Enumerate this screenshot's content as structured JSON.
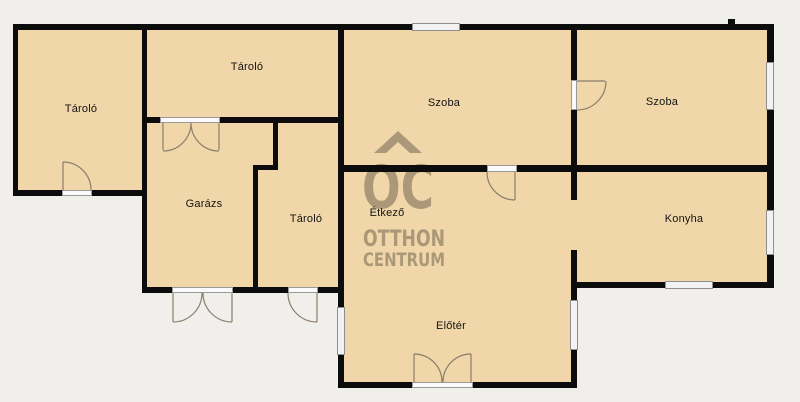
{
  "plan": {
    "type": "floorplan",
    "language": "hu"
  },
  "brand": {
    "logo_acronym": "OC",
    "name_line1": "OTTHON",
    "name_line2": "CENTRUM"
  },
  "rooms": [
    {
      "id": "storage-left",
      "label": "Tároló"
    },
    {
      "id": "storage-top",
      "label": "Tároló"
    },
    {
      "id": "room-left",
      "label": "Szoba"
    },
    {
      "id": "room-right",
      "label": "Szoba"
    },
    {
      "id": "garage",
      "label": "Garázs"
    },
    {
      "id": "storage-small",
      "label": "Tároló"
    },
    {
      "id": "dining",
      "label": "Étkező"
    },
    {
      "id": "kitchen",
      "label": "Konyha"
    },
    {
      "id": "foyer",
      "label": "Előtér"
    }
  ],
  "colors": {
    "floor": "#f0d6a8",
    "wall": "#0c0c0c",
    "background": "#f0efeb",
    "window_fill": "#f2f2f2",
    "frame_gray": "#8f8f8f",
    "arc_stroke": "#8a7e6c",
    "label_color": "#141414",
    "watermark": "rgba(100,90,73,0.50)"
  }
}
